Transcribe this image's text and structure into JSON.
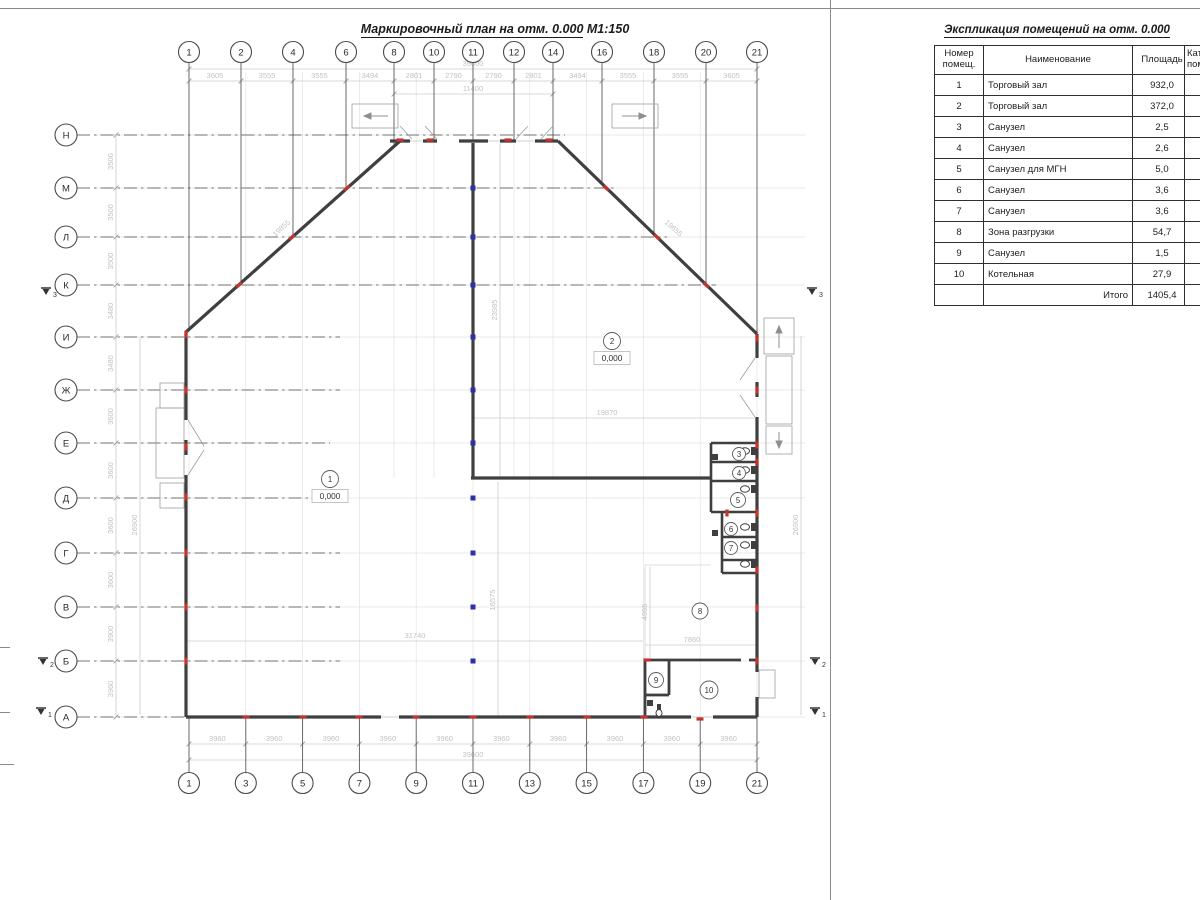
{
  "drawing": {
    "title": "Маркировочный план на отм. 0.000",
    "scale": "М1:150"
  },
  "table": {
    "title": "Экспликация помещений на отм. 0.000",
    "headers": {
      "num": "Номер помещ.",
      "name": "Наименование",
      "area": "Площадь",
      "cat": "Кат. пом"
    },
    "rows": [
      {
        "num": "1",
        "name": "Торговый зал",
        "area": "932,0"
      },
      {
        "num": "2",
        "name": "Торговый зал",
        "area": "372,0"
      },
      {
        "num": "3",
        "name": "Санузел",
        "area": "2,5"
      },
      {
        "num": "4",
        "name": "Санузел",
        "area": "2,6"
      },
      {
        "num": "5",
        "name": "Санузел для МГН",
        "area": "5,0"
      },
      {
        "num": "6",
        "name": "Санузел",
        "area": "3,6"
      },
      {
        "num": "7",
        "name": "Санузел",
        "area": "3,6"
      },
      {
        "num": "8",
        "name": "Зона разгрузки",
        "area": "54,7"
      },
      {
        "num": "9",
        "name": "Санузел",
        "area": "1,5"
      },
      {
        "num": "10",
        "name": "Котельная",
        "area": "27,9"
      }
    ],
    "total_label": "Итого",
    "total_value": "1405,4"
  },
  "plan": {
    "axes_top": [
      "1",
      "2",
      "4",
      "6",
      "8",
      "10",
      "11",
      "12",
      "14",
      "16",
      "18",
      "20",
      "21"
    ],
    "axes_bottom": [
      "1",
      "3",
      "5",
      "7",
      "9",
      "11",
      "13",
      "15",
      "17",
      "19",
      "21"
    ],
    "axes_left": [
      "Н",
      "М",
      "Л",
      "К",
      "И",
      "Ж",
      "Е",
      "Д",
      "Г",
      "В",
      "Б",
      "А"
    ],
    "dims_top": [
      "3605",
      "3555",
      "3555",
      "3494",
      "2801",
      "2790",
      "2790",
      "2801",
      "3494",
      "3555",
      "3555",
      "3605"
    ],
    "dim_top_overall": "39600",
    "dim_top_inner": "11400",
    "dims_bottom": [
      "3960",
      "3960",
      "3960",
      "3960",
      "3960",
      "3960",
      "3960",
      "3960",
      "3960",
      "3960"
    ],
    "dim_bottom_overall": "39600",
    "dims_left": [
      "3500",
      "3500",
      "3500",
      "3480",
      "3480",
      "3600",
      "3600",
      "3600",
      "3600",
      "3900",
      "3960"
    ],
    "dims_inner": [
      {
        "text": "31740"
      },
      {
        "text": "19870"
      },
      {
        "text": "7860"
      },
      {
        "text": "23985"
      },
      {
        "text": "16575"
      },
      {
        "text": "4955"
      },
      {
        "text": "19855"
      },
      {
        "text": "19655"
      },
      {
        "text": "26900"
      },
      {
        "text": "26900"
      }
    ],
    "rooms": [
      {
        "num": "1",
        "elev": "0,000"
      },
      {
        "num": "2",
        "elev": "0,000"
      },
      {
        "num": "3"
      },
      {
        "num": "4"
      },
      {
        "num": "5"
      },
      {
        "num": "6"
      },
      {
        "num": "7"
      },
      {
        "num": "8"
      },
      {
        "num": "9"
      },
      {
        "num": "10"
      }
    ],
    "section_labels": [
      "1",
      "2",
      "3"
    ]
  },
  "colors": {
    "wall": "#3f3f3f",
    "axis": "#4a4a4a",
    "dim_text": "#c2c2c2",
    "dim_line": "#cccccc",
    "construction": "#e3e3e3",
    "column_marker": "#2e2ea8",
    "wall_marker": "#c4342d"
  }
}
